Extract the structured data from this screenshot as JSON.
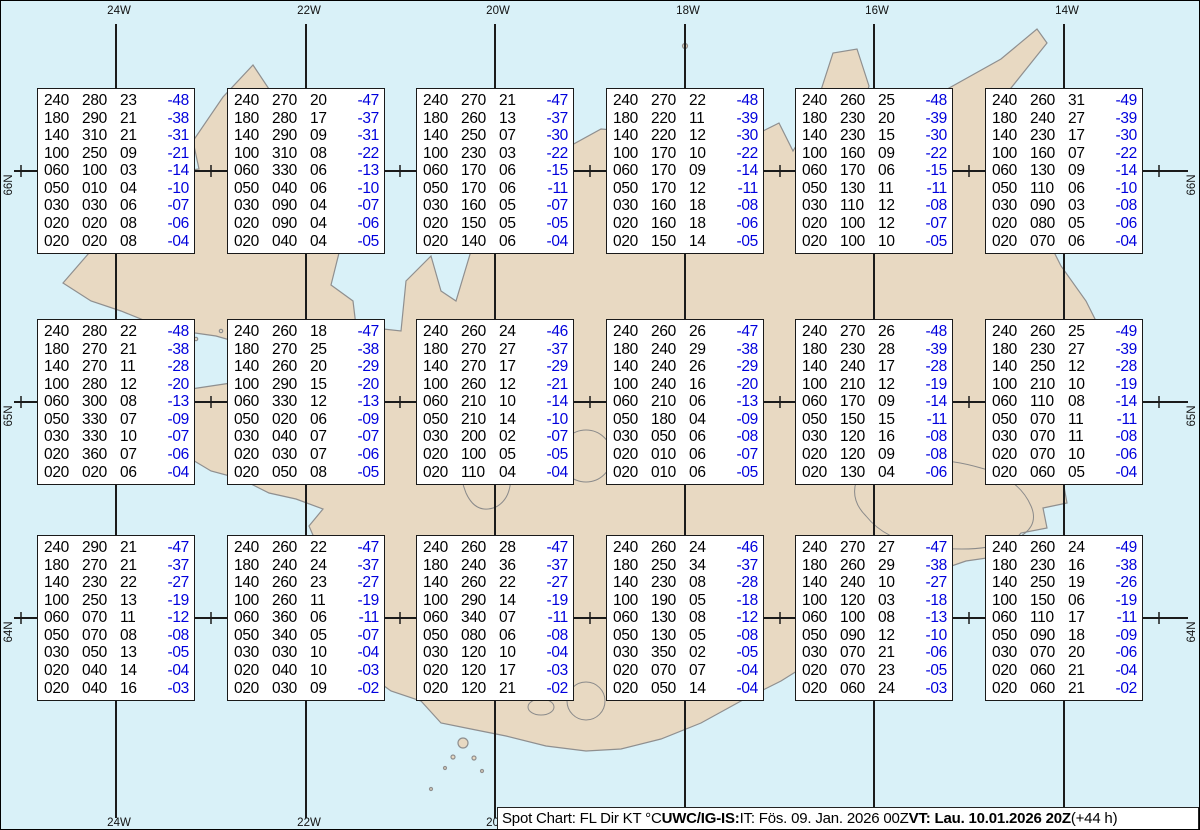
{
  "map": {
    "sea_color": "#d9f1f8",
    "land_color": "#e8d9c2",
    "coast_color": "#8f8f8f",
    "glacier_outline_color": "#8a8a8a",
    "grid_color": "#1b1b1b",
    "box_border_color": "#1a1a1a",
    "temp_color": "#0000dd",
    "meridians": [
      {
        "label": "24W",
        "x": 115
      },
      {
        "label": "22W",
        "x": 305
      },
      {
        "label": "20W",
        "x": 494
      },
      {
        "label": "18W",
        "x": 684
      },
      {
        "label": "16W",
        "x": 873
      },
      {
        "label": "14W",
        "x": 1063
      }
    ],
    "parallels": [
      {
        "label": "66N",
        "y": 170
      },
      {
        "label": "65N",
        "y": 401
      },
      {
        "label": "64N",
        "y": 617
      }
    ],
    "lon_tick_xs": [
      20,
      210,
      399,
      589,
      779,
      968,
      1158
    ]
  },
  "columns": [
    "FL",
    "Dir",
    "KT",
    "°C"
  ],
  "spots": [
    {
      "id": "66N24W",
      "cx": 115,
      "cy": 170,
      "rows": [
        [
          "240",
          "280",
          "23",
          "-48"
        ],
        [
          "180",
          "290",
          "21",
          "-38"
        ],
        [
          "140",
          "310",
          "21",
          "-31"
        ],
        [
          "100",
          "250",
          "09",
          "-21"
        ],
        [
          "060",
          "100",
          "03",
          "-14"
        ],
        [
          "050",
          "010",
          "04",
          "-10"
        ],
        [
          "030",
          "030",
          "06",
          "-07"
        ],
        [
          "020",
          "020",
          "08",
          "-06"
        ],
        [
          "020",
          "020",
          "08",
          "-04"
        ]
      ]
    },
    {
      "id": "66N22W",
      "cx": 305,
      "cy": 170,
      "rows": [
        [
          "240",
          "270",
          "20",
          "-47"
        ],
        [
          "180",
          "280",
          "17",
          "-37"
        ],
        [
          "140",
          "290",
          "09",
          "-31"
        ],
        [
          "100",
          "310",
          "08",
          "-22"
        ],
        [
          "060",
          "330",
          "06",
          "-13"
        ],
        [
          "050",
          "040",
          "06",
          "-10"
        ],
        [
          "030",
          "090",
          "04",
          "-07"
        ],
        [
          "020",
          "090",
          "04",
          "-06"
        ],
        [
          "020",
          "040",
          "04",
          "-05"
        ]
      ]
    },
    {
      "id": "66N20W",
      "cx": 494,
      "cy": 170,
      "rows": [
        [
          "240",
          "270",
          "21",
          "-47"
        ],
        [
          "180",
          "260",
          "13",
          "-37"
        ],
        [
          "140",
          "250",
          "07",
          "-30"
        ],
        [
          "100",
          "230",
          "03",
          "-22"
        ],
        [
          "060",
          "170",
          "06",
          "-15"
        ],
        [
          "050",
          "170",
          "06",
          "-11"
        ],
        [
          "030",
          "160",
          "05",
          "-07"
        ],
        [
          "020",
          "150",
          "05",
          "-05"
        ],
        [
          "020",
          "140",
          "06",
          "-04"
        ]
      ]
    },
    {
      "id": "66N18W",
      "cx": 684,
      "cy": 170,
      "rows": [
        [
          "240",
          "270",
          "22",
          "-48"
        ],
        [
          "180",
          "220",
          "11",
          "-39"
        ],
        [
          "140",
          "220",
          "12",
          "-30"
        ],
        [
          "100",
          "170",
          "10",
          "-22"
        ],
        [
          "060",
          "170",
          "09",
          "-14"
        ],
        [
          "050",
          "170",
          "12",
          "-11"
        ],
        [
          "030",
          "160",
          "18",
          "-08"
        ],
        [
          "020",
          "160",
          "18",
          "-06"
        ],
        [
          "020",
          "150",
          "14",
          "-05"
        ]
      ]
    },
    {
      "id": "66N16W",
      "cx": 873,
      "cy": 170,
      "rows": [
        [
          "240",
          "260",
          "25",
          "-48"
        ],
        [
          "180",
          "230",
          "20",
          "-39"
        ],
        [
          "140",
          "230",
          "15",
          "-30"
        ],
        [
          "100",
          "160",
          "09",
          "-22"
        ],
        [
          "060",
          "170",
          "06",
          "-15"
        ],
        [
          "050",
          "130",
          "11",
          "-11"
        ],
        [
          "030",
          "110",
          "12",
          "-08"
        ],
        [
          "020",
          "100",
          "12",
          "-07"
        ],
        [
          "020",
          "100",
          "10",
          "-05"
        ]
      ]
    },
    {
      "id": "66N14W",
      "cx": 1063,
      "cy": 170,
      "rows": [
        [
          "240",
          "260",
          "31",
          "-49"
        ],
        [
          "180",
          "240",
          "27",
          "-39"
        ],
        [
          "140",
          "230",
          "17",
          "-30"
        ],
        [
          "100",
          "160",
          "07",
          "-22"
        ],
        [
          "060",
          "130",
          "09",
          "-14"
        ],
        [
          "050",
          "110",
          "06",
          "-10"
        ],
        [
          "030",
          "090",
          "03",
          "-08"
        ],
        [
          "020",
          "080",
          "05",
          "-06"
        ],
        [
          "020",
          "070",
          "06",
          "-04"
        ]
      ]
    },
    {
      "id": "65N24W",
      "cx": 115,
      "cy": 401,
      "rows": [
        [
          "240",
          "280",
          "22",
          "-48"
        ],
        [
          "180",
          "270",
          "21",
          "-38"
        ],
        [
          "140",
          "270",
          "11",
          "-28"
        ],
        [
          "100",
          "280",
          "12",
          "-20"
        ],
        [
          "060",
          "300",
          "08",
          "-13"
        ],
        [
          "050",
          "330",
          "07",
          "-09"
        ],
        [
          "030",
          "330",
          "10",
          "-07"
        ],
        [
          "020",
          "360",
          "07",
          "-06"
        ],
        [
          "020",
          "020",
          "06",
          "-04"
        ]
      ]
    },
    {
      "id": "65N22W",
      "cx": 305,
      "cy": 401,
      "rows": [
        [
          "240",
          "260",
          "18",
          "-47"
        ],
        [
          "180",
          "270",
          "25",
          "-38"
        ],
        [
          "140",
          "260",
          "20",
          "-29"
        ],
        [
          "100",
          "290",
          "15",
          "-20"
        ],
        [
          "060",
          "330",
          "12",
          "-13"
        ],
        [
          "050",
          "020",
          "06",
          "-09"
        ],
        [
          "030",
          "040",
          "07",
          "-07"
        ],
        [
          "020",
          "030",
          "07",
          "-06"
        ],
        [
          "020",
          "050",
          "08",
          "-05"
        ]
      ]
    },
    {
      "id": "65N20W",
      "cx": 494,
      "cy": 401,
      "rows": [
        [
          "240",
          "260",
          "24",
          "-46"
        ],
        [
          "180",
          "270",
          "27",
          "-37"
        ],
        [
          "140",
          "270",
          "17",
          "-29"
        ],
        [
          "100",
          "260",
          "12",
          "-21"
        ],
        [
          "060",
          "210",
          "10",
          "-14"
        ],
        [
          "050",
          "210",
          "14",
          "-10"
        ],
        [
          "030",
          "200",
          "02",
          "-07"
        ],
        [
          "020",
          "100",
          "05",
          "-05"
        ],
        [
          "020",
          "110",
          "04",
          "-04"
        ]
      ]
    },
    {
      "id": "65N18W",
      "cx": 684,
      "cy": 401,
      "rows": [
        [
          "240",
          "260",
          "26",
          "-47"
        ],
        [
          "180",
          "240",
          "29",
          "-38"
        ],
        [
          "140",
          "240",
          "26",
          "-29"
        ],
        [
          "100",
          "240",
          "16",
          "-20"
        ],
        [
          "060",
          "210",
          "06",
          "-13"
        ],
        [
          "050",
          "180",
          "04",
          "-09"
        ],
        [
          "030",
          "050",
          "06",
          "-08"
        ],
        [
          "020",
          "010",
          "06",
          "-07"
        ],
        [
          "020",
          "010",
          "06",
          "-05"
        ]
      ]
    },
    {
      "id": "65N16W",
      "cx": 873,
      "cy": 401,
      "rows": [
        [
          "240",
          "270",
          "26",
          "-48"
        ],
        [
          "180",
          "230",
          "28",
          "-39"
        ],
        [
          "140",
          "240",
          "17",
          "-28"
        ],
        [
          "100",
          "210",
          "12",
          "-19"
        ],
        [
          "060",
          "170",
          "09",
          "-14"
        ],
        [
          "050",
          "150",
          "15",
          "-11"
        ],
        [
          "030",
          "120",
          "16",
          "-08"
        ],
        [
          "020",
          "120",
          "09",
          "-08"
        ],
        [
          "020",
          "130",
          "04",
          "-06"
        ]
      ]
    },
    {
      "id": "65N14W",
      "cx": 1063,
      "cy": 401,
      "rows": [
        [
          "240",
          "260",
          "25",
          "-49"
        ],
        [
          "180",
          "230",
          "27",
          "-39"
        ],
        [
          "140",
          "250",
          "12",
          "-28"
        ],
        [
          "100",
          "210",
          "10",
          "-19"
        ],
        [
          "060",
          "110",
          "08",
          "-14"
        ],
        [
          "050",
          "070",
          "11",
          "-11"
        ],
        [
          "030",
          "070",
          "11",
          "-08"
        ],
        [
          "020",
          "070",
          "10",
          "-06"
        ],
        [
          "020",
          "060",
          "05",
          "-04"
        ]
      ]
    },
    {
      "id": "64N24W",
      "cx": 115,
      "cy": 617,
      "rows": [
        [
          "240",
          "290",
          "21",
          "-47"
        ],
        [
          "180",
          "270",
          "21",
          "-37"
        ],
        [
          "140",
          "230",
          "22",
          "-27"
        ],
        [
          "100",
          "250",
          "13",
          "-19"
        ],
        [
          "060",
          "070",
          "11",
          "-12"
        ],
        [
          "050",
          "070",
          "08",
          "-08"
        ],
        [
          "030",
          "050",
          "13",
          "-05"
        ],
        [
          "020",
          "040",
          "14",
          "-04"
        ],
        [
          "020",
          "040",
          "16",
          "-03"
        ]
      ]
    },
    {
      "id": "64N22W",
      "cx": 305,
      "cy": 617,
      "rows": [
        [
          "240",
          "260",
          "22",
          "-47"
        ],
        [
          "180",
          "240",
          "24",
          "-37"
        ],
        [
          "140",
          "260",
          "23",
          "-27"
        ],
        [
          "100",
          "260",
          "11",
          "-19"
        ],
        [
          "060",
          "360",
          "06",
          "-11"
        ],
        [
          "050",
          "340",
          "05",
          "-07"
        ],
        [
          "030",
          "030",
          "10",
          "-04"
        ],
        [
          "020",
          "040",
          "10",
          "-03"
        ],
        [
          "020",
          "030",
          "09",
          "-02"
        ]
      ]
    },
    {
      "id": "64N20W",
      "cx": 494,
      "cy": 617,
      "rows": [
        [
          "240",
          "260",
          "28",
          "-47"
        ],
        [
          "180",
          "240",
          "36",
          "-37"
        ],
        [
          "140",
          "260",
          "22",
          "-27"
        ],
        [
          "100",
          "290",
          "14",
          "-19"
        ],
        [
          "060",
          "340",
          "07",
          "-11"
        ],
        [
          "050",
          "080",
          "06",
          "-08"
        ],
        [
          "030",
          "120",
          "10",
          "-04"
        ],
        [
          "020",
          "120",
          "17",
          "-03"
        ],
        [
          "020",
          "120",
          "21",
          "-02"
        ]
      ]
    },
    {
      "id": "64N18W",
      "cx": 684,
      "cy": 617,
      "rows": [
        [
          "240",
          "260",
          "24",
          "-46"
        ],
        [
          "180",
          "250",
          "34",
          "-37"
        ],
        [
          "140",
          "230",
          "08",
          "-28"
        ],
        [
          "100",
          "190",
          "05",
          "-18"
        ],
        [
          "060",
          "130",
          "08",
          "-12"
        ],
        [
          "050",
          "130",
          "05",
          "-08"
        ],
        [
          "030",
          "350",
          "02",
          "-05"
        ],
        [
          "020",
          "070",
          "07",
          "-04"
        ],
        [
          "020",
          "050",
          "14",
          "-04"
        ]
      ]
    },
    {
      "id": "64N16W",
      "cx": 873,
      "cy": 617,
      "rows": [
        [
          "240",
          "270",
          "27",
          "-47"
        ],
        [
          "180",
          "260",
          "29",
          "-38"
        ],
        [
          "140",
          "240",
          "10",
          "-27"
        ],
        [
          "100",
          "120",
          "03",
          "-18"
        ],
        [
          "060",
          "100",
          "08",
          "-13"
        ],
        [
          "050",
          "090",
          "12",
          "-10"
        ],
        [
          "030",
          "070",
          "21",
          "-06"
        ],
        [
          "020",
          "070",
          "23",
          "-05"
        ],
        [
          "020",
          "060",
          "24",
          "-03"
        ]
      ]
    },
    {
      "id": "64N14W",
      "cx": 1063,
      "cy": 617,
      "rows": [
        [
          "240",
          "260",
          "24",
          "-49"
        ],
        [
          "180",
          "230",
          "16",
          "-38"
        ],
        [
          "140",
          "250",
          "19",
          "-26"
        ],
        [
          "100",
          "150",
          "06",
          "-19"
        ],
        [
          "060",
          "110",
          "17",
          "-11"
        ],
        [
          "050",
          "090",
          "18",
          "-09"
        ],
        [
          "030",
          "070",
          "20",
          "-06"
        ],
        [
          "020",
          "060",
          "21",
          "-04"
        ],
        [
          "020",
          "060",
          "21",
          "-02"
        ]
      ]
    }
  ],
  "footer": {
    "parts": [
      {
        "text": "Spot Chart: FL Dir KT °C ",
        "bold": false
      },
      {
        "text": "UWC/IG-IS:",
        "bold": true
      },
      {
        "text": " IT: Fös. 09. Jan. 2026 00Z ",
        "bold": false
      },
      {
        "text": "VT: Lau. 10.01.2026 20Z",
        "bold": true
      },
      {
        "text": " (+44 h)",
        "bold": false
      }
    ]
  }
}
